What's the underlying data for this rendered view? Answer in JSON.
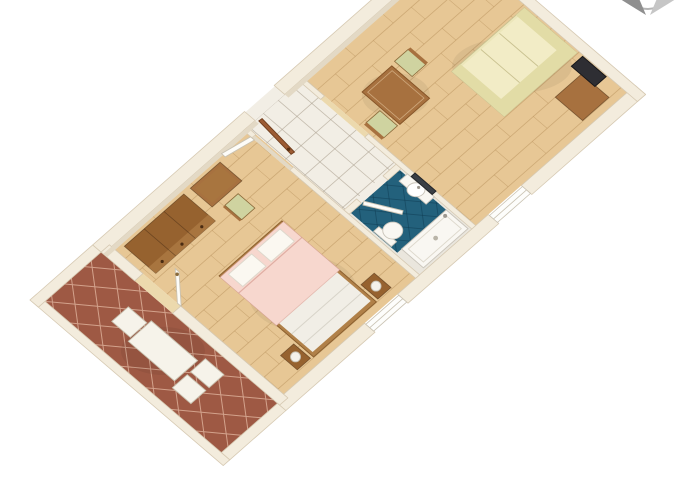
{
  "image": {
    "kind": "3d-floor-plan-rendering",
    "description": "Top-down 3D rendering of a one-bedroom apartment rotated diagonally: terracotta-tiled terrace with white dining set, bedroom with double bed and wooden furniture, white-tiled hallway with open entry door, blue-tiled bathroom with sink, mirror, toilet and bathtub, and a living room with dining table, cream sofa, desk and TV. Partial grey compass rose at top right.",
    "background": "#ffffff"
  },
  "palette": {
    "wall_top": "#f3ecdd",
    "wall_edge": "#d6c9b2",
    "wall_face": "#e3d9c5",
    "terrace_tile": "#9e5944",
    "terrace_grout": "#d3a28c",
    "wood_floor": "#e7c795",
    "wood_line": "rgba(164,120,66,0.38)",
    "hall_tile": "#f2eee5",
    "hall_grout": "rgba(172,162,145,0.65)",
    "bath_base": "#eae6dd",
    "bath_tile": "#23617c",
    "bath_grout": "rgba(16,62,84,0.55)",
    "white_furniture": "#f6f3ea",
    "white_furniture_edge": "#c9c2b0",
    "dark_wood": "#96622f",
    "dark_wood_front": "#a8753f",
    "mid_wood": "#a7713f",
    "mid_wood_edge": "#845327",
    "bed_frame": "#b08048",
    "duvet_pink": "#f7d7ce",
    "duvet_fold": "rgba(205,140,128,0.55)",
    "pillow_white": "#fbf8f1",
    "sheet_white": "#f1eee6",
    "sheet_line": "#d8d4c9",
    "chair_seat": "#cfd3a0",
    "sofa_base": "#ece6ba",
    "sofa_seat": "#f2ecc6",
    "sofa_back": "#e2dca6",
    "sofa_edge": "#c9c190",
    "tv_dark": "#2e2e33",
    "door_brown": "#9c5b33",
    "door_brown_edge": "#6e3c1c",
    "door_white": "#fdfcf8",
    "door_white_edge": "#c9c2b2",
    "fixture_white": "#f9f7f2",
    "fixture_edge": "#c9c4ba",
    "mirror_dark": "#3a3f45",
    "window_white": "#fdfdfb",
    "threshold_wood": "#ecd9ad",
    "shadow": "rgba(0,0,0,0.055)",
    "compass_dark": "#8f8f8f",
    "compass_light": "#c6c6c6",
    "compass_arc": "#b5b5b5"
  },
  "rooms": [
    {
      "id": "terrace",
      "floor": "terracotta-diagonal-tiles"
    },
    {
      "id": "bedroom",
      "floor": "wood-parquet"
    },
    {
      "id": "hallway",
      "floor": "white-tiles"
    },
    {
      "id": "bathroom",
      "floor": "blue-diagonal-tiles"
    },
    {
      "id": "living-room",
      "floor": "wood-parquet"
    }
  ],
  "furniture": [
    {
      "room": "terrace",
      "id": "terrace-table"
    },
    {
      "room": "terrace",
      "id": "terrace-chair"
    },
    {
      "room": "bedroom",
      "id": "wardrobe-chest"
    },
    {
      "room": "bedroom",
      "id": "desk"
    },
    {
      "room": "bedroom",
      "id": "desk-chair"
    },
    {
      "room": "bedroom",
      "id": "double-bed"
    },
    {
      "room": "bedroom",
      "id": "nightstand-lamp"
    },
    {
      "room": "hallway",
      "id": "entrance-door"
    },
    {
      "room": "bathroom",
      "id": "sink-with-mirror"
    },
    {
      "room": "bathroom",
      "id": "toilet"
    },
    {
      "room": "bathroom",
      "id": "bathtub"
    },
    {
      "room": "living-room",
      "id": "dining-table"
    },
    {
      "room": "living-room",
      "id": "dining-chair"
    },
    {
      "room": "living-room",
      "id": "sofa"
    },
    {
      "room": "living-room",
      "id": "side-desk"
    },
    {
      "room": "living-room",
      "id": "tv"
    }
  ]
}
